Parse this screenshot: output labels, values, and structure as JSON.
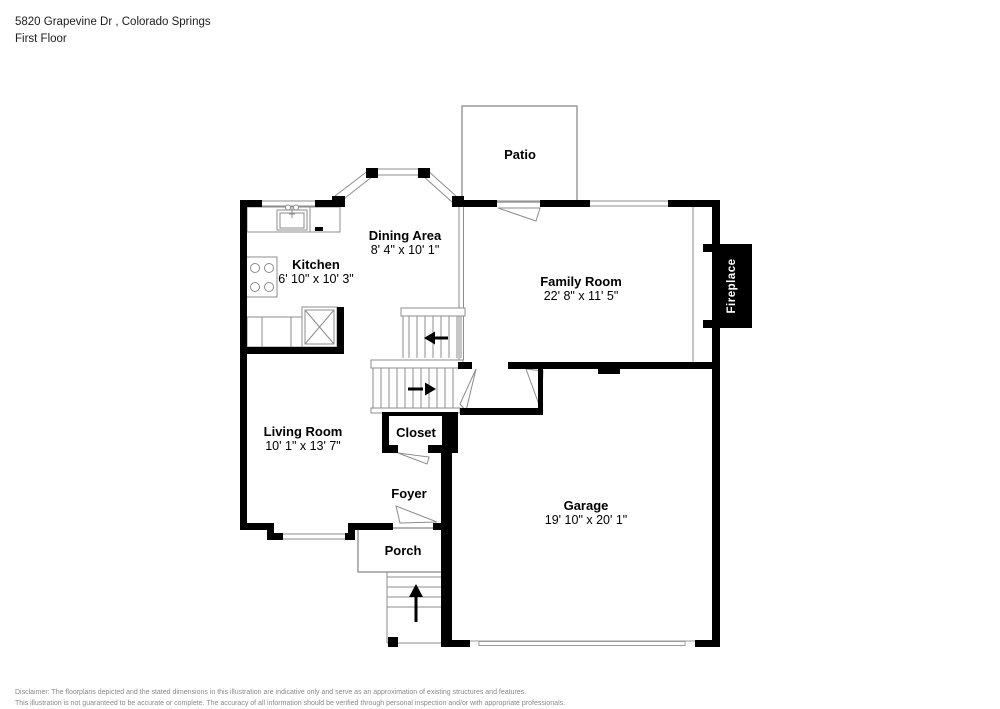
{
  "header": {
    "address": "5820 Grapevine Dr , Colorado Springs",
    "floor": "First Floor"
  },
  "rooms": {
    "patio": {
      "name": "Patio"
    },
    "dining": {
      "name": "Dining Area",
      "dims": "8' 4\" x 10' 1\""
    },
    "kitchen": {
      "name": "Kitchen",
      "dims": "6' 10\" x 10' 3\""
    },
    "family": {
      "name": "Family Room",
      "dims": "22' 8\" x 11' 5\""
    },
    "living": {
      "name": "Living Room",
      "dims": "10' 1\" x 13' 7\""
    },
    "closet": {
      "name": "Closet"
    },
    "foyer": {
      "name": "Foyer"
    },
    "porch": {
      "name": "Porch"
    },
    "garage": {
      "name": "Garage",
      "dims": "19' 10\" x 20' 1\""
    }
  },
  "fireplace": {
    "label": "Fireplace"
  },
  "icons": {
    "upper_stairs_arrow": "left-arrow",
    "lower_stairs_arrow": "right-arrow",
    "front_steps_arrow": "up-arrow"
  },
  "colors": {
    "wall": "#000000",
    "thin_line": "#8c8c8c",
    "outdoor_outline": "#9b9b9b",
    "fireplace_fill": "#000000",
    "fireplace_text": "#ffffff",
    "disclaimer_text": "#8a8a8a"
  },
  "disclaimer": {
    "line1": "Disclaimer: The floorplans depicted and the stated dimensions in this illustration are indicative only and serve as an approximation of existing structures and features.",
    "line2": "This illustration is not guaranteed to be accurate or complete. The accuracy of all information should be verified through personal inspection and/or with appropriate professionals."
  }
}
